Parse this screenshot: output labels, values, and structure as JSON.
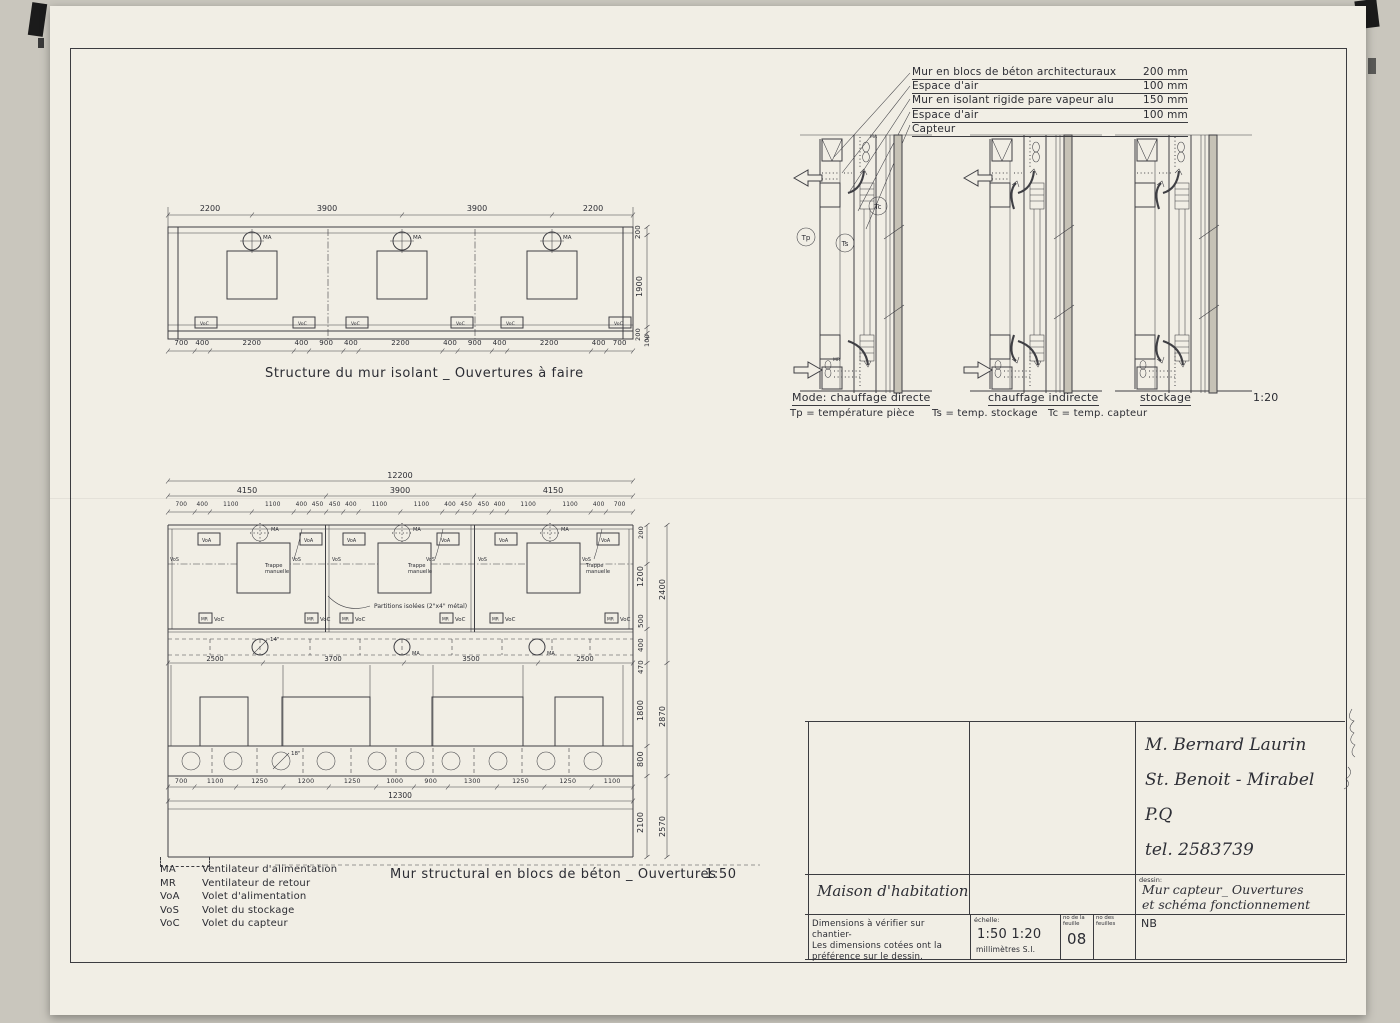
{
  "labels": {
    "ma": "MA",
    "mr": "MR",
    "voa": "VoA",
    "vos": "VoS",
    "voc": "VoC"
  },
  "top_drawing": {
    "caption": "Structure du mur isolant _ Ouvertures à faire",
    "top_dims": [
      {
        "t": "2200",
        "w": 2200
      },
      {
        "t": "3900",
        "w": 3900
      },
      {
        "t": "3900",
        "w": 3900
      },
      {
        "t": "2200",
        "w": 2200
      }
    ],
    "bottom_dims": [
      {
        "t": "700",
        "w": 700
      },
      {
        "t": "400",
        "w": 400
      },
      {
        "t": "2200",
        "w": 2200
      },
      {
        "t": "400",
        "w": 400
      },
      {
        "t": "900",
        "w": 900
      },
      {
        "t": "400",
        "w": 400
      },
      {
        "t": "2200",
        "w": 2200
      },
      {
        "t": "400",
        "w": 400
      },
      {
        "t": "900",
        "w": 900
      },
      {
        "t": "400",
        "w": 400
      },
      {
        "t": "2200",
        "w": 2200
      },
      {
        "t": "400",
        "w": 400
      },
      {
        "t": "700",
        "w": 700
      }
    ],
    "right_dims": {
      "d1": "200",
      "d2": "1900",
      "d3": "200",
      "d4": "100"
    }
  },
  "bottom_drawing": {
    "caption": "Mur structural en blocs de béton _ Ouvertures",
    "scale": "1:50",
    "total_top": "12200",
    "total_bottom": "12300",
    "bays": [
      {
        "t": "4150",
        "w": 4150
      },
      {
        "t": "3900",
        "w": 3900
      },
      {
        "t": "4150",
        "w": 4150
      }
    ],
    "detail_dims": [
      {
        "t": "700",
        "w": 700
      },
      {
        "t": "400",
        "w": 400
      },
      {
        "t": "1100",
        "w": 1100
      },
      {
        "t": "1100",
        "w": 1100
      },
      {
        "t": "400",
        "w": 400
      },
      {
        "t": "450",
        "w": 450
      },
      {
        "t": "450",
        "w": 450
      },
      {
        "t": "400",
        "w": 400
      },
      {
        "t": "1100",
        "w": 1100
      },
      {
        "t": "1100",
        "w": 1100
      },
      {
        "t": "400",
        "w": 400
      },
      {
        "t": "450",
        "w": 450
      },
      {
        "t": "450",
        "w": 450
      },
      {
        "t": "400",
        "w": 400
      },
      {
        "t": "1100",
        "w": 1100
      },
      {
        "t": "1100",
        "w": 1100
      },
      {
        "t": "400",
        "w": 400
      },
      {
        "t": "700",
        "w": 700
      }
    ],
    "mid_dims": [
      {
        "t": "2500",
        "w": 2500
      },
      {
        "t": "3700",
        "w": 3700
      },
      {
        "t": "3500",
        "w": 3500
      },
      {
        "t": "2500",
        "w": 2500
      }
    ],
    "hole_dims": [
      {
        "t": "700",
        "w": 700
      },
      {
        "t": "1100",
        "w": 1100
      },
      {
        "t": "1250",
        "w": 1250
      },
      {
        "t": "1200",
        "w": 1200
      },
      {
        "t": "1250",
        "w": 1250
      },
      {
        "t": "1000",
        "w": 1000
      },
      {
        "t": "900",
        "w": 900
      },
      {
        "t": "1300",
        "w": 1300
      },
      {
        "t": "1250",
        "w": 1250
      },
      {
        "t": "1250",
        "w": 1250
      },
      {
        "t": "1100",
        "w": 1100
      }
    ],
    "trappe_1": "Trappe",
    "trappe_2": "manuelle",
    "partitions": "Partitions isolées (2\"x4\" métal)",
    "d14": "14\"",
    "d18": "18\"",
    "right_dims": {
      "r200": "200",
      "r1200": "1200",
      "r500": "500",
      "r400": "400",
      "r470": "470",
      "r2400": "2400",
      "r1800": "1800",
      "r800": "800",
      "r2870": "2870",
      "r2100": "2100",
      "r2570": "2570"
    }
  },
  "legend": {
    "items": [
      {
        "t": "MA",
        "v": "Ventilateur d'alimentation"
      },
      {
        "t": "MR",
        "v": "Ventilateur de retour"
      },
      {
        "t": "VoA",
        "v": "Volet d'alimentation"
      },
      {
        "t": "VoS",
        "v": "Volet du stockage"
      },
      {
        "t": "VoC",
        "v": "Volet du capteur"
      }
    ]
  },
  "sections": {
    "layers": [
      {
        "t": "Mur en blocs de béton architecturaux",
        "v": "200 mm"
      },
      {
        "t": "Espace d'air",
        "v": "100 mm"
      },
      {
        "t": "Mur en isolant rigide pare vapeur alu",
        "v": "150 mm"
      },
      {
        "t": "Espace d'air",
        "v": "100 mm"
      },
      {
        "t": "Capteur",
        "v": ""
      }
    ],
    "mode_1": "Mode: chauffage directe",
    "mode_2": "chauffage indirecte",
    "mode_3": "stockage",
    "scale": "1:20",
    "temps": [
      "Tp = température pièce",
      "Ts = temp. stockage",
      "Tc = temp. capteur"
    ],
    "sensors": {
      "tp": "Tp",
      "ts": "Ts",
      "tc": "Tc"
    }
  },
  "title_block": {
    "client_lines": [
      "M. Bernard Laurin",
      "St. Benoit - Mirabel P.Q",
      "tel. 2583739"
    ],
    "project": "Maison d'habitation",
    "drawing_label": "dessin:",
    "drawing_title_lines": [
      "Mur capteur_ Ouvertures",
      "et schéma fonctionnement"
    ],
    "note_lines": [
      "Dimensions à vérifier sur chantier-",
      "Les dimensions cotées ont la",
      "préférence sur le dessin."
    ],
    "scale_label": "échelle:",
    "scales": "1:50    1:20",
    "units": "millimètres  S.I.",
    "sheet_label": "no de la feuille",
    "sheet_no": "08",
    "sheets_label": "no des feuilles",
    "initials": "NB"
  }
}
